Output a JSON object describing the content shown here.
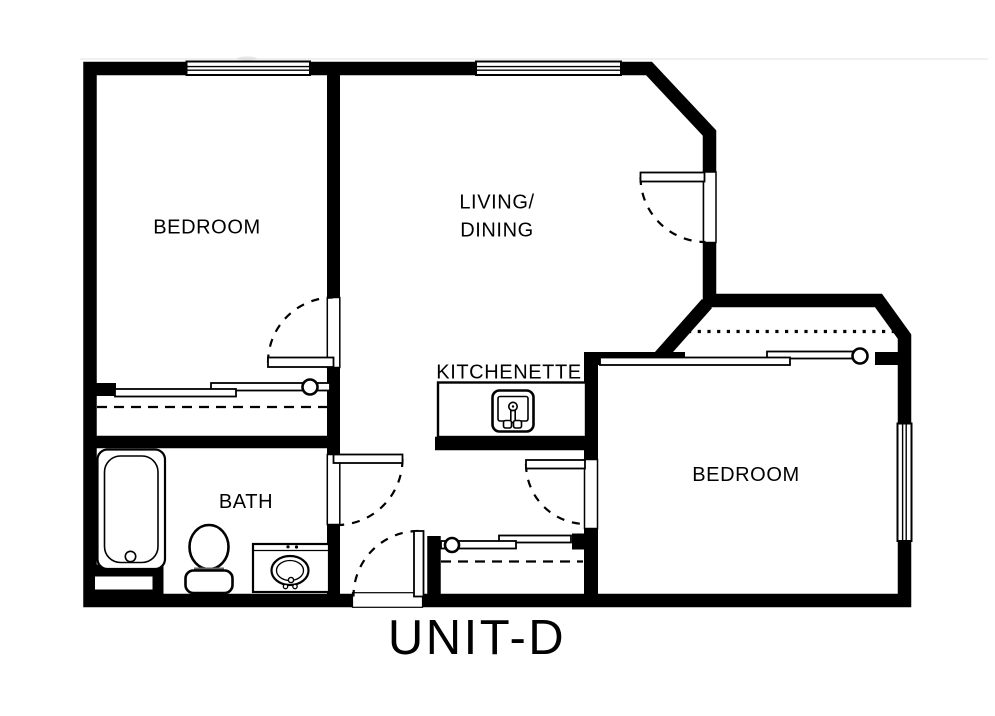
{
  "plan": {
    "unit_label": "UNIT-D",
    "rooms": {
      "bedroom_left": {
        "label": "BEDROOM"
      },
      "living_dining": {
        "line1": "LIVING/",
        "line2": "DINING"
      },
      "kitchenette": {
        "label": "KITCHENETTE"
      },
      "bath": {
        "label": "BATH"
      },
      "bedroom_right": {
        "label": "BEDROOM"
      }
    },
    "colors": {
      "wall": "#000000",
      "background": "#ffffff"
    },
    "features": {
      "windows": 3,
      "swing_doors": 5,
      "sliding_door_closets": 3,
      "fixtures": [
        "bathtub",
        "toilet",
        "vanity-sink",
        "kitchenette-sink"
      ]
    }
  }
}
